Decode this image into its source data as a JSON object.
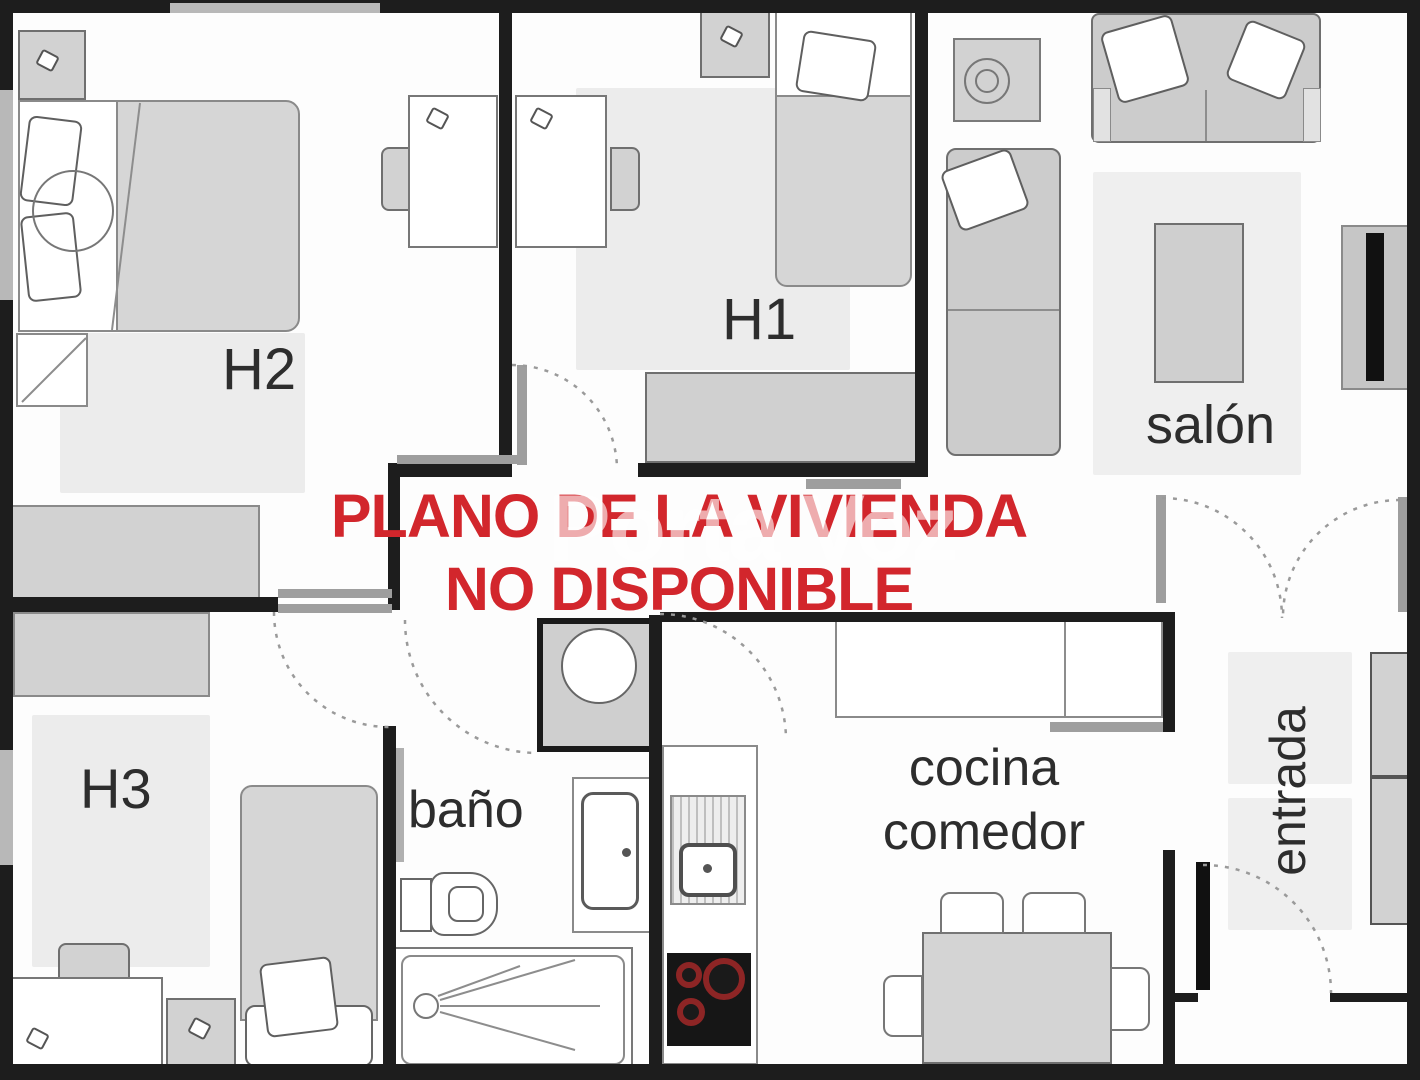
{
  "floorplan": {
    "notice": {
      "line1": "PLANO DE LA VIVIENDA",
      "line2": "NO DISPONIBLE",
      "color": "#d2262c"
    },
    "site_watermark": {
      "text": "Porta Voz",
      "color": "#ffffff"
    },
    "labels": {
      "h1": "H1",
      "h2": "H2",
      "h3": "H3",
      "salon": "salón",
      "bano": "baño",
      "cocina": "cocina",
      "comedor": "comedor",
      "entrada": "entrada"
    },
    "colors": {
      "wall": "#1d1d1d",
      "furniture_fill": "#d2d2d2",
      "rug": "#ececec",
      "window": "#b8b8b8",
      "door_arc": "#9a9a9a",
      "hob_burner": "#8d2525"
    }
  }
}
